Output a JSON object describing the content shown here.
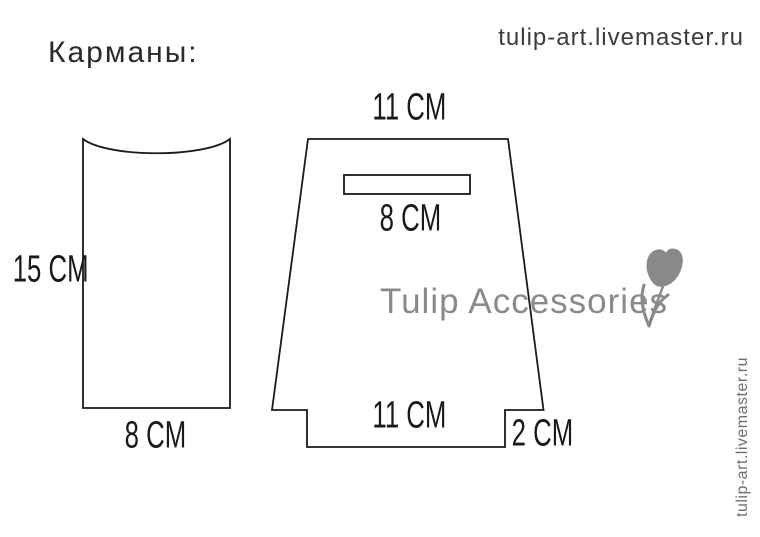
{
  "header": {
    "title": "Карманы:",
    "site_url": "tulip-art.livemaster.ru"
  },
  "watermark": {
    "brand": "Tulip Accessories",
    "side_url": "tulip-art.livemaster.ru",
    "tulip_icon": "tulip-flower-glyph"
  },
  "left_piece": {
    "height_label": "15 CM",
    "width_label": "8 CM"
  },
  "right_piece": {
    "top_width_label": "11 CM",
    "slot_width_label": "8 CM",
    "bottom_width_label": "11 CM",
    "step_height_label": "2 CM"
  },
  "colors": {
    "outline": "#1a1a1a",
    "label_text": "#1a1a1a",
    "title_text": "#2a2a2a",
    "top_url_text": "#3c3c3c",
    "watermark_gray": "#8a8a8a",
    "side_url_gray": "#6f6f6f",
    "background": "#ffffff"
  }
}
